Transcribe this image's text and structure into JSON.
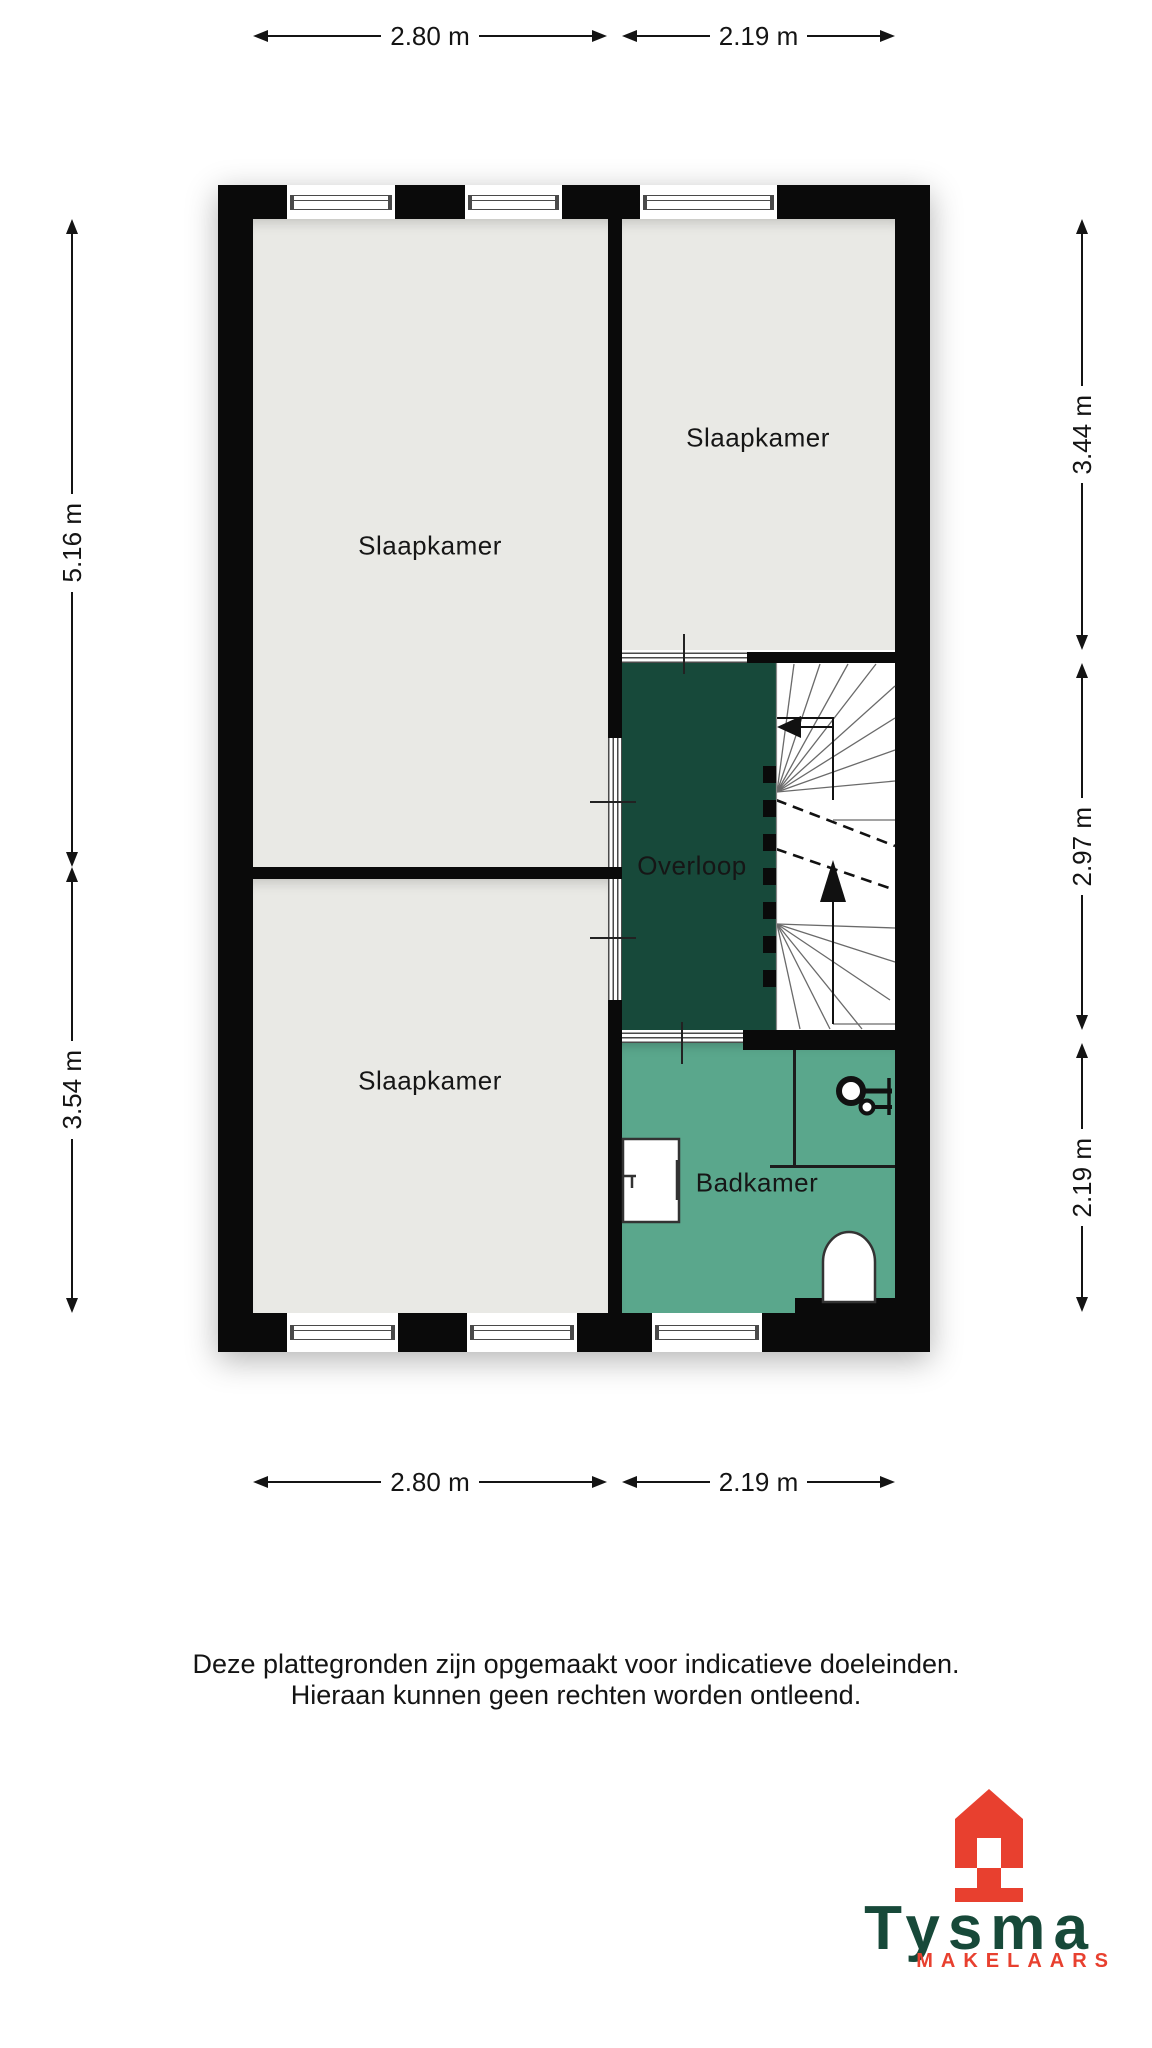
{
  "plan": {
    "rooms": [
      {
        "id": "slaapkamer-top-left",
        "label": "Slaapkamer"
      },
      {
        "id": "slaapkamer-top-right",
        "label": "Slaapkamer"
      },
      {
        "id": "slaapkamer-bottom-left",
        "label": "Slaapkamer"
      },
      {
        "id": "overloop",
        "label": "Overloop"
      },
      {
        "id": "badkamer",
        "label": "Badkamer"
      }
    ],
    "dimensions": {
      "top": [
        "2.80 m",
        "2.19 m"
      ],
      "bottom": [
        "2.80 m",
        "2.19 m"
      ],
      "left": [
        "5.16 m",
        "3.54 m"
      ],
      "right": [
        "3.44 m",
        "2.97 m",
        "2.19 m"
      ]
    }
  },
  "disclaimer": {
    "line1": "Deze plattegronden zijn opgemaakt voor indicatieve doeleinden.",
    "line2": "Hieraan kunnen geen rechten worden ontleend."
  },
  "logo": {
    "name": "Tysma",
    "tagline": "MAKELAARS"
  },
  "colors": {
    "wall": "#0a0a0a",
    "floor": "#e9e9e5",
    "overloop": "#17493a",
    "badkamer": "#5aa78c",
    "logo_green": "#174939",
    "logo_red": "#e8402f"
  }
}
